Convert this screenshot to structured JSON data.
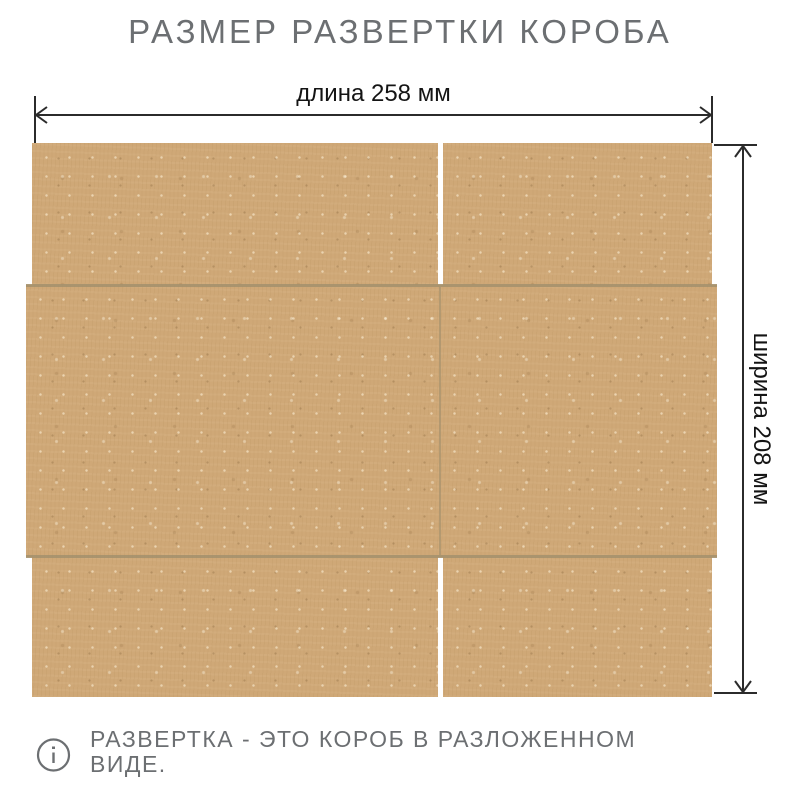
{
  "title": "РАЗМЕР РАЗВЕРТКИ КОРОБА",
  "dimensions": {
    "length": {
      "label": "длина 258 мм",
      "value_mm": 258
    },
    "width": {
      "label": "ширина 208 мм",
      "value_mm": 208
    }
  },
  "note": {
    "lines": [
      "РАЗВЕРТКА - ЭТО КОРОБ В РАЗЛОЖЕННОМ",
      "ВИДЕ."
    ]
  },
  "icons": {
    "info": "info-icon",
    "length_arrow": "double-arrow-horizontal-icon",
    "width_arrow": "double-arrow-vertical-icon"
  },
  "colors": {
    "kraft_base": "#cfa877",
    "crease": "#a5916d",
    "dimension_line": "#2b2b2b",
    "muted_text": "#6c6f72",
    "dark_text": "#141414"
  }
}
